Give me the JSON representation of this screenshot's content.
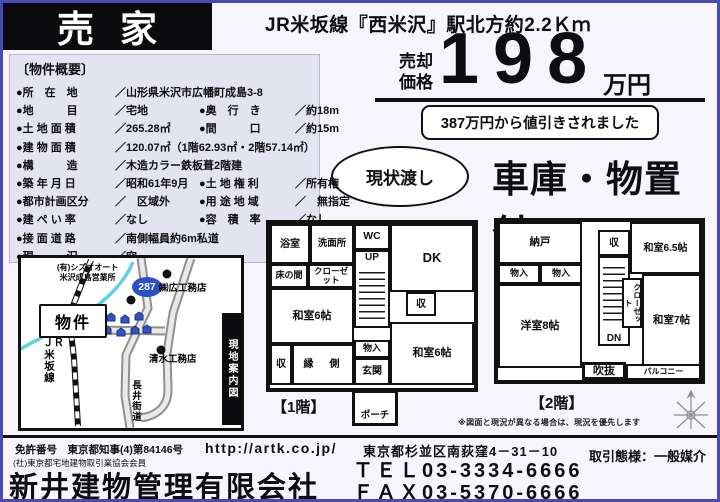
{
  "header": {
    "sale_banner": "売家",
    "station_info": "JR米坂線『西米沢』駅北方約2.2Ｋｍ"
  },
  "price": {
    "label_top": "売却",
    "label_bottom": "価格",
    "amount": "198",
    "unit": "万円",
    "discount_note": "387万円から値引きされました",
    "condition_badge": "現状渡し",
    "feature_headline": "車庫・物置付"
  },
  "overview": {
    "title": "〔物件概要〕",
    "rows": [
      {
        "l1": "●所　在　地",
        "v1": "／山形県米沢市広幡町成島3-8"
      },
      {
        "l1": "●地　　　目",
        "v1": "／宅地",
        "l2": "●奥　行　き",
        "v2": "／約18m"
      },
      {
        "l1": "●土 地 面 積",
        "v1": "／265.28㎡",
        "l2": "●間　　　口",
        "v2": "／約15m"
      },
      {
        "l1": "●建 物 面 積",
        "v1": "／120.07㎡（1階62.93㎡・2階57.14㎡）"
      },
      {
        "l1": "●構　　　造",
        "v1": "／木造カラー鉄板葺2階建"
      },
      {
        "l1": "●築 年 月 日",
        "v1": "／昭和61年9月",
        "l2": "●土 地 権 利",
        "v2": "／所有権"
      },
      {
        "l1": "●都市計画区分",
        "v1": "／　区域外",
        "l2": "●用 途 地 域",
        "v2": "／　無指定"
      },
      {
        "l1": "●建 ぺ い 率",
        "v1": "／なし",
        "l2": "●容　積　率",
        "v2": "／なし"
      },
      {
        "l1": "●接 面 道 路",
        "v1": "／南側幅員約6m私道"
      },
      {
        "l1": "●現　　　況",
        "v1": "／空"
      }
    ]
  },
  "map": {
    "strip_caption": "現地案内図",
    "property_label": "物件",
    "route_badge": "287",
    "labels": {
      "shizu_auto_line1": "(有)シズオオート",
      "shizu_auto_line2": "米沢成島営業所",
      "hiro_builder": "㈱広工務店",
      "shimizu_builder": "清水工務店",
      "nagai_road": "長井街道",
      "jr_line_top": "ＪＲ",
      "jr_line_bottom": "米坂線"
    }
  },
  "floorplan1": {
    "caption": "【1階】",
    "rooms": {
      "bath": "浴室",
      "washroom": "洗面所",
      "wc": "WC",
      "stairs": "UP",
      "dk": "DK",
      "tokonoma": "床の間",
      "closet": "クローゼット",
      "washitsu_left": "和室6帖",
      "storage_right": "収",
      "washitsu_right": "和室6帖",
      "storage_mid": "物入",
      "entrance": "玄関",
      "storage_bottom": "収",
      "engawa": "縁　側",
      "porch": "ポーチ"
    }
  },
  "floorplan2": {
    "caption": "【2階】",
    "rooms": {
      "nando": "納戸",
      "storage": "収",
      "washitsu65": "和室6.5帖",
      "mono1": "物入",
      "mono2": "物入",
      "stairs": "DN",
      "closet": "クローゼット",
      "yoshitsu8": "洋室8帖",
      "washitsu7": "和室7帖",
      "fukinuke": "吹抜",
      "balcony": "バルコニー"
    }
  },
  "notes": {
    "disclaimer": "※図面と現況が異なる場合は、現況を優先します"
  },
  "footer": {
    "license": "免許番号　東京都知事(4)第84146号",
    "membership": "(社)東京都宅地建物取引業協会会員",
    "company": "新井建物管理有限会社",
    "url": "http://artk.co.jp/",
    "address": "東京都杉並区南荻窪4－31－10",
    "tel": "ＴＥＬ03-3334-6666",
    "fax": "ＦＡＸ03-5370-6666",
    "agency": "取引態様：一般媒介"
  }
}
